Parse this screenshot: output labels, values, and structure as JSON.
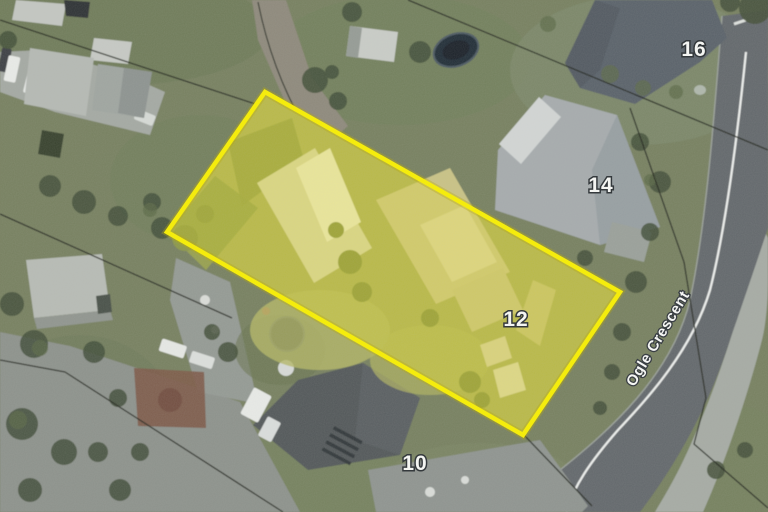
{
  "page": {
    "title": "Aerial parcel map"
  },
  "map": {
    "type": "aerial-imagery",
    "street_label": "Ogle Crescent",
    "house_numbers": {
      "n16": "16",
      "n14": "14",
      "n12": "12",
      "n10": "10"
    },
    "highlighted_parcel": {
      "number": "12",
      "street": "Ogle Crescent",
      "highlight_border_color": "#F8EF00",
      "highlight_fill_color": "#F6EC00"
    },
    "road": {
      "name": "Ogle Crescent",
      "surface_color": "#63686C",
      "centerline_color": "#EEF0EE"
    },
    "boundary_line_color": "#23271F"
  }
}
